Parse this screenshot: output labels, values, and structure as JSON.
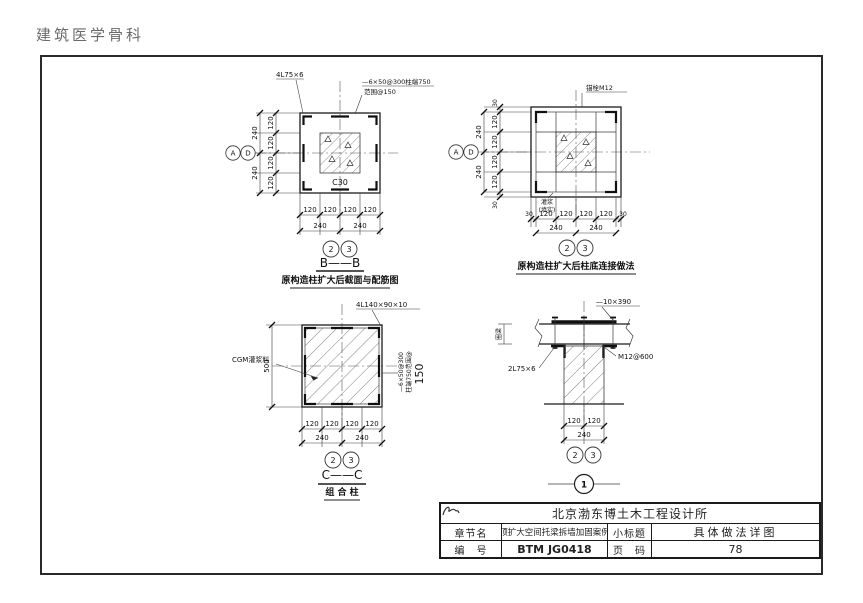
{
  "header": {
    "doc_title": "建筑医学骨科"
  },
  "d1": {
    "label_angle": "4L75×6",
    "note_line1": "—6×50@300柱端750",
    "note_line2": "范围@150",
    "concrete": "C30",
    "axis_a": "A",
    "axis_d": "D",
    "axis_2": "2",
    "axis_3": "3",
    "dims_left_inner": [
      "120",
      "120",
      "120",
      "120"
    ],
    "dims_left_outer": [
      "240",
      "240"
    ],
    "dims_bottom_inner": [
      "120",
      "120",
      "120",
      "120"
    ],
    "dims_bottom_outer": [
      "240",
      "240"
    ],
    "section": "B——B",
    "caption": "原构造柱扩大后截面与配筋图"
  },
  "d2": {
    "label_anchor": "锚栓M12",
    "label_grout1": "灌浆",
    "label_grout2": "(填实)",
    "axis_a": "A",
    "axis_d": "D",
    "axis_2": "2",
    "axis_3": "3",
    "dims_left_inner": [
      "30",
      "120",
      "120",
      "120",
      "120",
      "30"
    ],
    "dims_left_outer": [
      "240",
      "240"
    ],
    "dims_bottom_inner": [
      "30",
      "120",
      "120",
      "120",
      "120",
      "30"
    ],
    "dims_bottom_outer": [
      "240",
      "240"
    ],
    "caption": "原构造柱扩大后柱底连接做法"
  },
  "d3": {
    "label_angle": "4L140×90×10",
    "label_grout": "CGM灌浆料",
    "note_v1": "—6×50@300",
    "note_v2": "柱端750范围@",
    "note_v3": "150",
    "dim_height": "500",
    "axis_2": "2",
    "axis_3": "3",
    "dims_bottom_inner": [
      "120",
      "120",
      "120",
      "120"
    ],
    "dims_bottom_outer": [
      "240",
      "240"
    ],
    "section": "C——C",
    "caption": "组 合 柱"
  },
  "d4": {
    "label_plate": "—10×390",
    "label_angle": "2L75×6",
    "label_bolt": "M12@600",
    "label_ringbeam": "圈梁",
    "axis_2": "2",
    "axis_3": "3",
    "detail_no": "1",
    "dims_bottom_inner": [
      "120",
      "120"
    ],
    "dims_bottom_outer": [
      "240"
    ]
  },
  "titleblock": {
    "company": "北京渤东博土木工程设计所",
    "chapter_label": "章节名",
    "chapter_value": "顶扩大空间托梁拆墙加固案例",
    "subtitle_label": "小标题",
    "subtitle_value": "具体做法详图",
    "number_label": "编　号",
    "number_value": "BTM JG0418",
    "page_label": "页　码",
    "page_value": "78"
  }
}
